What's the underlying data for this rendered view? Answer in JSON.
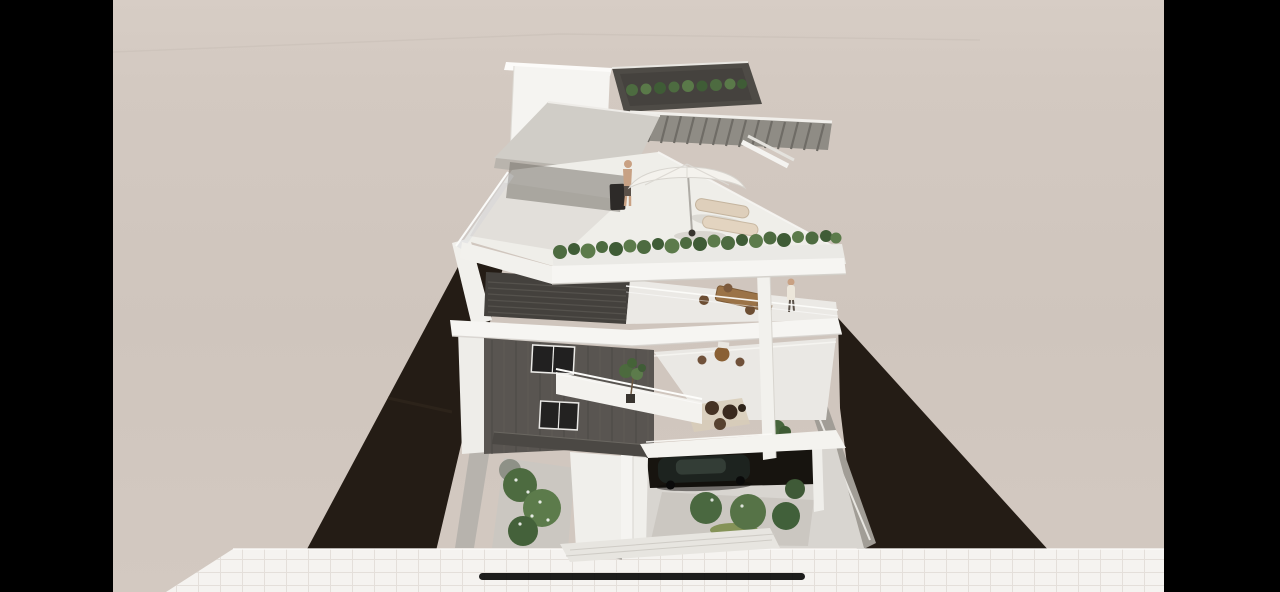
{
  "screen": {
    "description": "Full-screen 3D architectural rendering of a modern multi-storey apartment building with stacked, slightly rotated white floor plates, glass balustrades, dark facade panels, a rooftop terrace and landscaped ground floor, shown between black pillarbox bars with a system home indicator at the bottom.",
    "has_text": false
  },
  "palette": {
    "letterbox": "#000000",
    "background_top": "#d7cdc5",
    "background": "#cfc5bd",
    "street": "#f5f3f0",
    "street_grid": "#e2ddd7",
    "shadow_wedge": "#241c15",
    "sunlit_wall": "#a19d96",
    "building_white": "#f3f2ee",
    "slab_white": "#f6f5f2",
    "canopy_grey": "#d0cdc7",
    "pergola_grey": "#8f8c85",
    "roof_deck_dark": "#4e4b46",
    "louver_wall": "#44413d",
    "plank_wall": "#595551",
    "window_dark": "#212020",
    "carport_dark": "#17140f",
    "car_black": "#1d231f",
    "foliage_dark": "#3f5c36",
    "foliage": "#4d6b40",
    "foliage_light": "#5c7b4b",
    "lounger_beige": "#decfbb",
    "wood_brown": "#9b7347",
    "skin_tan": "#c9a183",
    "home_indicator": "#0c0c0c"
  },
  "objects": {
    "scene": "architectural 3D rendering of a modern apartment building",
    "background": "plain overcast backdrop",
    "street": "white paved street with tile grid",
    "shadow_wall_left": "dark boundary wall in shadow, left side",
    "shadow_wall_right": "dark boundary wall in shadow, right side",
    "boundary_wall": "sunlit boundary wall strip",
    "building": "multi-storey apartment building with rotated floor plates",
    "penthouse": "white rooftop penthouse volume",
    "roof_deck": "dark rooftop deck with hedge planter",
    "pergola": "slatted pergola roof deck",
    "canopy": "large cantilevered canopy roof",
    "roof_terrace": "rooftop terrace floor",
    "parasol": "white patio umbrella",
    "loungers": "two sun loungers",
    "barbecue": "barbecue grill",
    "person_roof": "person standing on the rooftop terrace",
    "planter": "green planter hedge along terrace edge",
    "balcony_level2": "balcony with outdoor dining set",
    "person_balcony": "person standing at balcony railing",
    "louver_panel": "dark louvered facade panel",
    "plank_wall": "dark timber-plank facade wall",
    "window_upper": "facade window, upper",
    "window_lower": "facade window, lower",
    "balcony_ramp": "diagonal white balcony with railing",
    "balcony_tree": "potted tree on balcony",
    "terrace_dining": "terrace dining furniture",
    "lounge_set": "lounge set with poufs and rug",
    "potted_plant": "potted plant on terrace",
    "column": "white support column",
    "carport": "ground-floor carport opening",
    "car": "dark parked car",
    "garden_left": "landscaped garden bed, left",
    "garden_center": "landscaped garden bed, center",
    "side_path": "grey side path",
    "walkway": "white entrance walkway",
    "steps": "entrance steps to street",
    "letterbox_left": "black letterbox bar, left",
    "letterbox_right": "black letterbox bar, right",
    "home_indicator": "home indicator bar"
  }
}
